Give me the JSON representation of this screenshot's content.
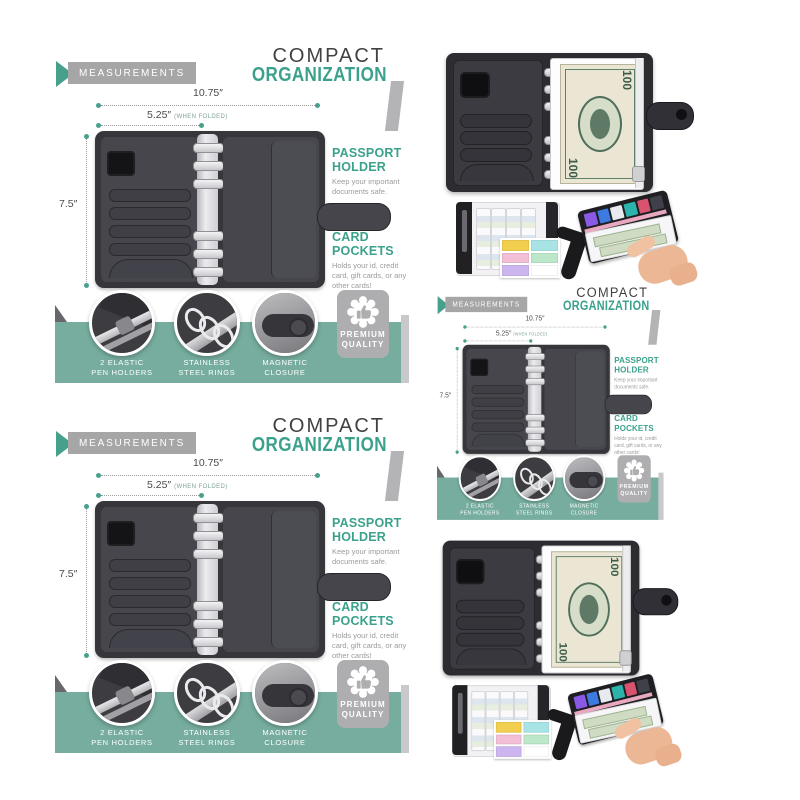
{
  "colors": {
    "teal_accent": "#3ba18c",
    "teal_band": "#76ad9f",
    "badge_gray": "#a6a6a6",
    "title_dark": "#414141",
    "caption_gray": "#9b9b9b",
    "binder_dark": "#36363b",
    "background": "#ffffff"
  },
  "icons": {
    "header_arrow": "chevron-right-icon",
    "premium_seal": "thumbs-up-seal-icon"
  },
  "measurements_panel": {
    "badge_label": "MEASUREMENTS",
    "title_top": "COMPACT",
    "title_bottom": "ORGANIZATION",
    "dims": {
      "width_label": "10.75″",
      "folded_label": "5.25″",
      "folded_note": "(WHEN FOLDED)",
      "height_label": "7.5″"
    },
    "features": [
      {
        "heading": "PASSPORT HOLDER",
        "caption": "Keep your important documents safe."
      },
      {
        "heading": "CARD POCKETS",
        "caption": "Holds your id, credit card, gift cards, or any other cards!"
      }
    ],
    "callouts": [
      {
        "line1": "2 ELASTIC",
        "line2": "PEN HOLDERS"
      },
      {
        "line1": "STAINLESS",
        "line2": "STEEL RINGS"
      },
      {
        "line1": "MAGNETIC",
        "line2": "CLOSURE"
      }
    ],
    "premium": {
      "line1": "PREMIUM",
      "line2": "QUALITY"
    }
  },
  "photo_panel": {
    "bill_value": "100",
    "sticker_colors": [
      "#f2cf4e",
      "#a8e4e6",
      "#f2bfd6",
      "#bce7c8",
      "#cdb6ef",
      "#ffffff"
    ],
    "card_colors": [
      "#8a5ae6",
      "#3d7ae0",
      "#e8eaf0",
      "#2cb4ac",
      "#d9536e",
      "#40404a"
    ]
  }
}
